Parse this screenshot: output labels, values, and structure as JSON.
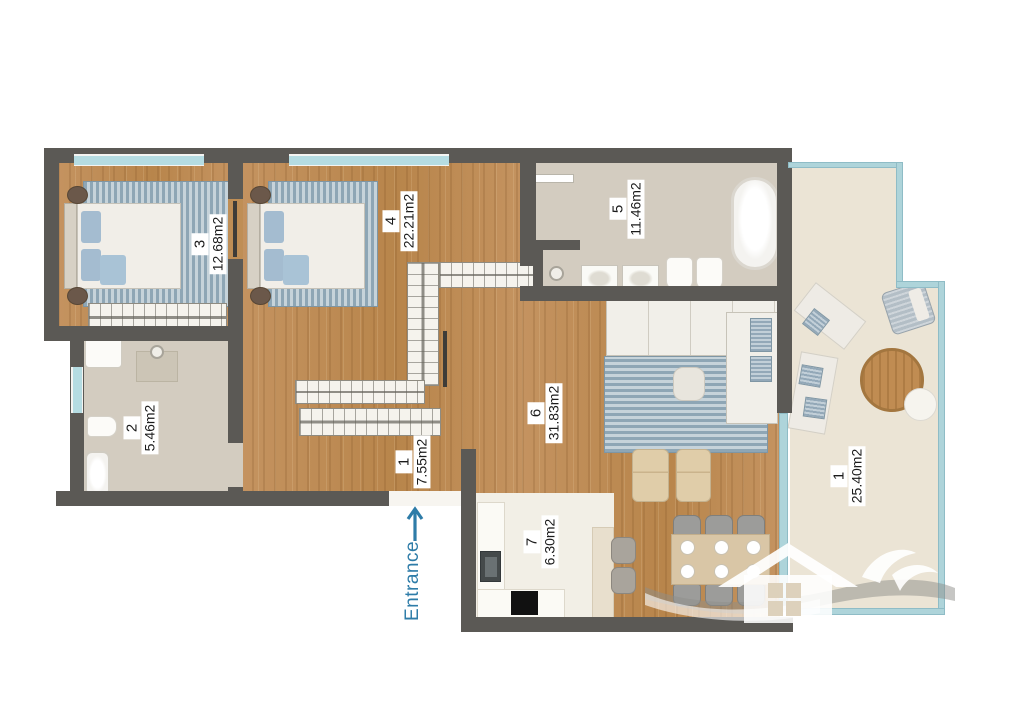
{
  "floorplan": {
    "rooms": [
      {
        "number": "1",
        "area": "7.55m2",
        "name": "hallway"
      },
      {
        "number": "2",
        "area": "5.46m2",
        "name": "bathroom"
      },
      {
        "number": "3",
        "area": "12.68m2",
        "name": "bedroom"
      },
      {
        "number": "4",
        "area": "22.21m2",
        "name": "master-bedroom"
      },
      {
        "number": "5",
        "area": "11.46m2",
        "name": "main-bathroom"
      },
      {
        "number": "6",
        "area": "31.83m2",
        "name": "living-room"
      },
      {
        "number": "7",
        "area": "6.30m2",
        "name": "kitchen"
      },
      {
        "number": "1",
        "area": "25.40m2",
        "name": "balcony"
      }
    ],
    "entrance_label": "Entrance",
    "colors": {
      "wall": "#5b5955",
      "wood_floor": "#bf8e55",
      "tile_floor": "#d3ccc0",
      "balcony_floor": "#ebe4d5",
      "glass": "#aed4da",
      "entrance_accent": "#2e7ca8",
      "rug": "#9db2c0"
    }
  }
}
